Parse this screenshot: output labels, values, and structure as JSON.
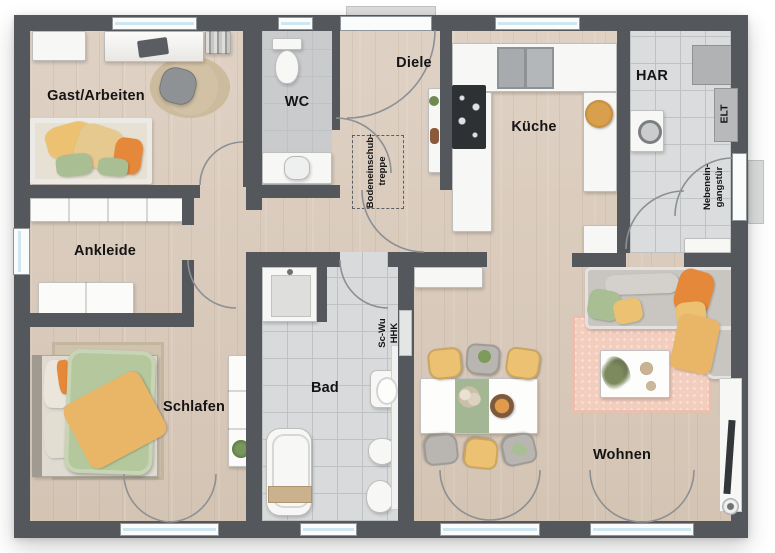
{
  "plan": {
    "rooms": [
      {
        "id": "gast-arbeiten",
        "label": "Gast/Arbeiten"
      },
      {
        "id": "wc",
        "label": "WC"
      },
      {
        "id": "diele",
        "label": "Diele"
      },
      {
        "id": "kueche",
        "label": "Küche"
      },
      {
        "id": "har",
        "label": "HAR"
      },
      {
        "id": "ankleide",
        "label": "Ankleide"
      },
      {
        "id": "schlafen",
        "label": "Schlafen"
      },
      {
        "id": "bad",
        "label": "Bad"
      },
      {
        "id": "wohnen",
        "label": "Wohnen"
      }
    ],
    "annotations": {
      "atticLadder": "Bodeneinschub-\ntreppe",
      "badWall": "Sc-Wu\nHHK",
      "elt": "ELT",
      "sideEntrance": "Nebenein-\ngangstür"
    },
    "colors": {
      "wall": "#54575b",
      "wood": "#dbccbd",
      "tileWc": "#c9cbcc",
      "tileBad": "#d8dadb",
      "tileHar": "#dadcdd",
      "tileLine": "#bfc2c3",
      "glass": "#cfe6f0",
      "frame": "#fafbfb",
      "arc": "#8d9093",
      "furnWhite": "#f7f7f5",
      "sofaGray": "#c9c6c1",
      "accentOrange": "#e5883a",
      "accentYellow": "#ecc272",
      "accentGreen": "#a9bf93",
      "rugPink": "#f3cdbd",
      "rugTan": "#cdbb9e",
      "bedGreen": "#b5c79c",
      "text": "#141414"
    }
  }
}
